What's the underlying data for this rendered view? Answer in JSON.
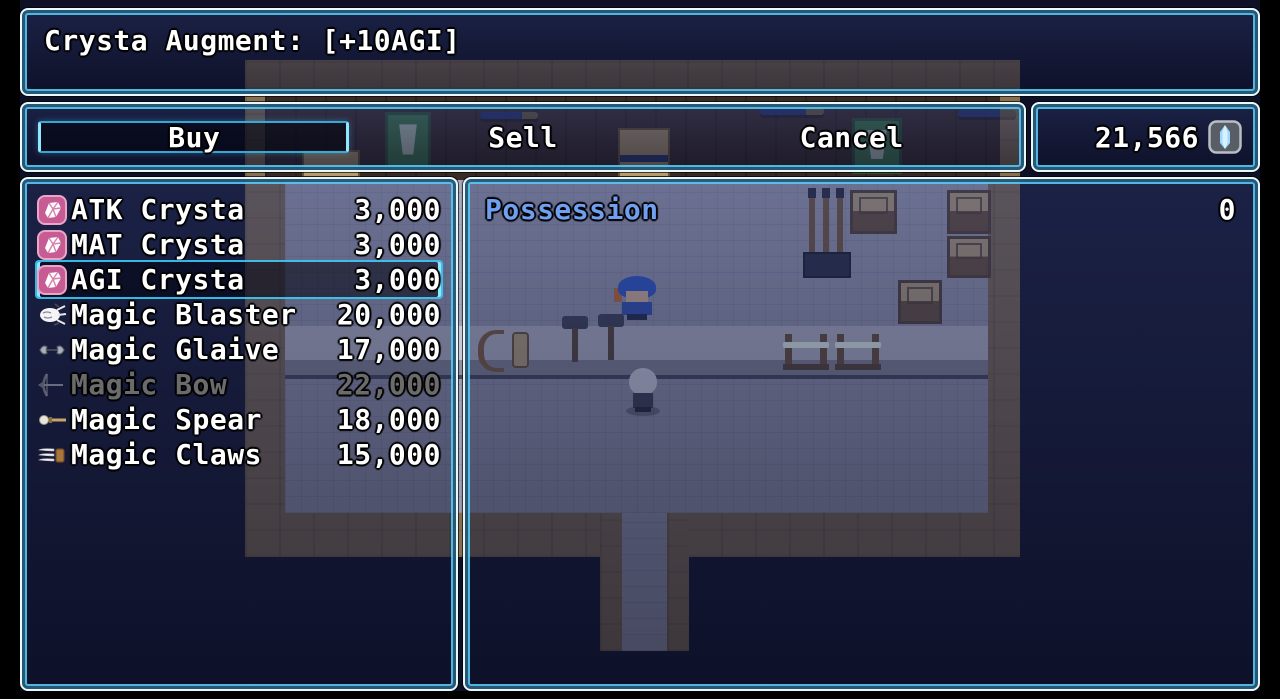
{
  "help": {
    "text": "Crysta Augment: [+10AGI]"
  },
  "commands": {
    "buy": "Buy",
    "sell": "Sell",
    "cancel": "Cancel",
    "selected": "buy"
  },
  "gold": {
    "amount": "21,566",
    "currency_icon": "crysta-currency-icon"
  },
  "shop_items": [
    {
      "name": "ATK Crysta",
      "price": "3,000",
      "icon": "crysta",
      "enabled": true,
      "selected": false
    },
    {
      "name": "MAT Crysta",
      "price": "3,000",
      "icon": "crysta",
      "enabled": true,
      "selected": false
    },
    {
      "name": "AGI Crysta",
      "price": "3,000",
      "icon": "crysta",
      "enabled": true,
      "selected": true
    },
    {
      "name": "Magic Blaster",
      "price": "20,000",
      "icon": "blaster",
      "enabled": true,
      "selected": false
    },
    {
      "name": "Magic Glaive",
      "price": "17,000",
      "icon": "glaive",
      "enabled": true,
      "selected": false
    },
    {
      "name": "Magic Bow",
      "price": "22,000",
      "icon": "bow",
      "enabled": false,
      "selected": false
    },
    {
      "name": "Magic Spear",
      "price": "18,000",
      "icon": "spear",
      "enabled": true,
      "selected": false
    },
    {
      "name": "Magic Claws",
      "price": "15,000",
      "icon": "claws",
      "enabled": true,
      "selected": false
    }
  ],
  "status": {
    "possession_label": "Possession",
    "possession_value": "0"
  },
  "colors": {
    "window_border_outer": "#e9f7ff",
    "window_border_inner": "#56c8f5",
    "cursor_accent": "#8ee9ff",
    "system_text": "#6f9ff0",
    "text": "#ffffff",
    "crysta_item_icon_bg": "#c75b94",
    "currency_gem": "#9fd9ff"
  }
}
